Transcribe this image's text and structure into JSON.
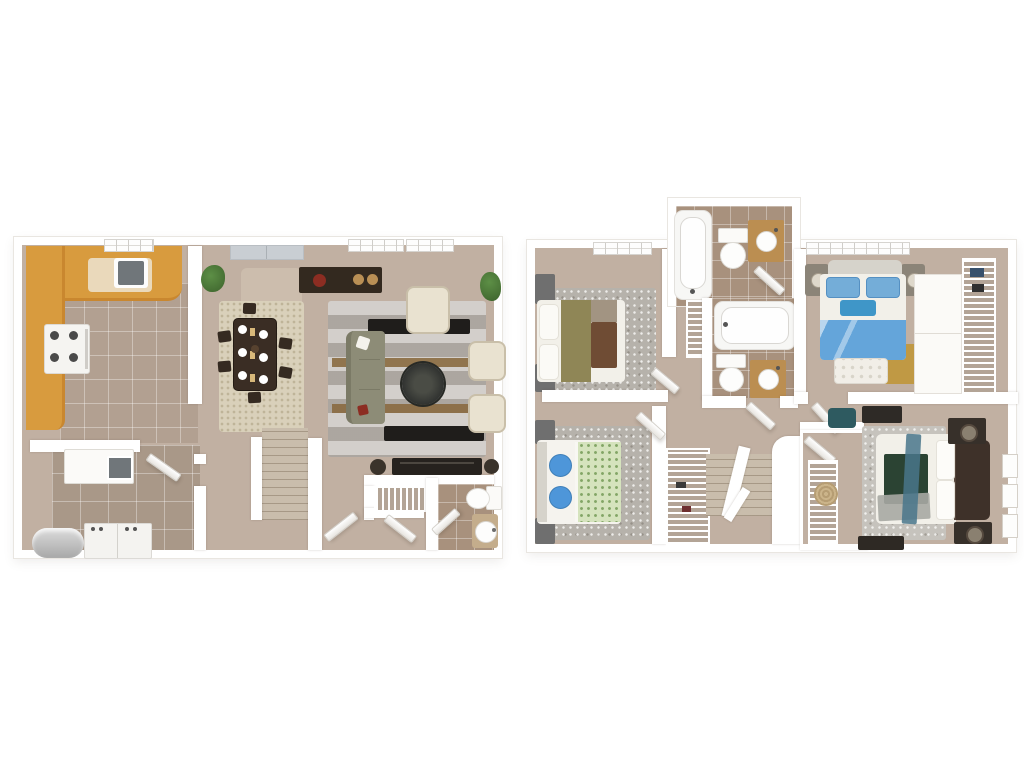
{
  "image_type": "3d-floor-plan-rendering",
  "text_content": "none-visible",
  "palette": {
    "canvas": "#ffffff",
    "wall": "#ffffff",
    "carpet_tan": "#c1b0a2",
    "kitchen_tile": "#b2a091",
    "laundry_tile": "#a99888",
    "bath_tile": "#a8917d",
    "wood_counter": "#d89b3e",
    "wood_counter_face": "#c9872f",
    "counter_cream": "#ead9bb",
    "wood_vanity": "#bb8e51",
    "dark_wood": "#3a2d24",
    "console_dark": "#33291f",
    "media_dark": "#26221e",
    "dining_rug": "#d9d0ba",
    "living_rug": "#bcb6af",
    "runner_brown": "#8a6a40",
    "bench_black": "#1f1d1b",
    "sofa_olive": "#8d8c77",
    "chair_cream": "#e9e2d0",
    "rug_flecked_gray": "#b6b2ab",
    "rug_flecked_light": "#c6c3bd",
    "bed_white": "#f2f0e9",
    "blanket_olive": "#8f8656",
    "throw_brown": "#6f4c34",
    "pillow_taupe": "#a29482",
    "pillow_blue": "#4e96d9",
    "quilt_green_floral": "#d5e3bd",
    "headboard_gray": "#d6d3cb",
    "blanket_blue": "#64a5da",
    "pillow_sky": "#74add8",
    "accent_teal": "#3f96c8",
    "bench_tufted": "#f1eee7",
    "rug_gold": "#c09944",
    "blanket_dark_green": "#2b4333",
    "throw_gray": "#a7a8a3",
    "drape_teal": "#49758b",
    "headboard_darkwood": "#3e3129",
    "nightstand_gray": "#6f6f6f",
    "nightstand_dark": "#37302a",
    "chair_teal": "#2e5a60",
    "stair_carpet": "#c9bdac",
    "plant_green": "#4e7c3b",
    "heater_gray": "#c2c2c2",
    "slider_gray": "#c9ced3",
    "fixture_white": "#fbfaf8",
    "steel_sink": "#70767a",
    "light_patch": "#cfc1b0"
  },
  "floors": [
    {
      "id": "first-floor",
      "position": "left",
      "rooms": [
        {
          "name": "kitchen",
          "furniture": [
            "u-shaped-wood-counter",
            "stainless-sink",
            "stove",
            "tile-floor",
            "window"
          ]
        },
        {
          "name": "dining-area",
          "furniture": [
            "cream-shag-rug",
            "dark-wood-table",
            "six-chairs",
            "place-settings",
            "sliding-glass-door",
            "potted-plant"
          ]
        },
        {
          "name": "living-room",
          "furniture": [
            "striped-rug",
            "olive-sofa",
            "three-cream-armchairs",
            "round-coffee-table",
            "two-black-benches",
            "dark-console",
            "media-console",
            "two-speaker-stools",
            "windows",
            "potted-plant"
          ]
        },
        {
          "name": "laundry-utility-room",
          "furniture": [
            "water-heater",
            "washer-dryer",
            "utility-sink-counter",
            "tile-floor"
          ]
        },
        {
          "name": "entry-hallway",
          "furniture": [
            "staircase-up",
            "front-door"
          ]
        },
        {
          "name": "coat-closet",
          "furniture": [
            "wire-shelving"
          ]
        },
        {
          "name": "half-bathroom",
          "furniture": [
            "toilet",
            "pedestal-sink",
            "tile-floor"
          ]
        }
      ]
    },
    {
      "id": "second-floor",
      "position": "right",
      "rooms": [
        {
          "name": "bedroom-1",
          "furniture": [
            "bed-olive-brown-bedding",
            "two-gray-nightstands",
            "flecked-rug",
            "windows"
          ]
        },
        {
          "name": "hall-bathroom",
          "furniture": [
            "bathtub",
            "toilet",
            "wood-vanity-sink",
            "tile-floor"
          ]
        },
        {
          "name": "second-bathroom",
          "furniture": [
            "bathtub",
            "toilet",
            "wood-vanity-sink",
            "tile-floor"
          ]
        },
        {
          "name": "linen-closet",
          "furniture": [
            "wire-shelving"
          ]
        },
        {
          "name": "bedroom-2",
          "furniture": [
            "bed-blue-bedding",
            "tufted-bench",
            "two-nightstands-with-lamps",
            "gold-rug",
            "closet-doors",
            "wire-shelving",
            "windows"
          ]
        },
        {
          "name": "bedroom-3",
          "furniture": [
            "bed-green-floral-quilt",
            "blue-pillows",
            "two-nightstands",
            "flecked-rug"
          ]
        },
        {
          "name": "upstairs-hallway",
          "furniture": [
            "staircase-down",
            "railing",
            "hall-closet-wire-shelving"
          ]
        },
        {
          "name": "bedroom-4-master",
          "furniture": [
            "bed-dark-green-bedding",
            "dark-wood-headboard",
            "two-nightstands-with-lamps",
            "walk-in-closet-wire-shelving",
            "woven-basket",
            "teal-chair",
            "dresser",
            "wall-frames",
            "rug"
          ]
        }
      ]
    }
  ]
}
